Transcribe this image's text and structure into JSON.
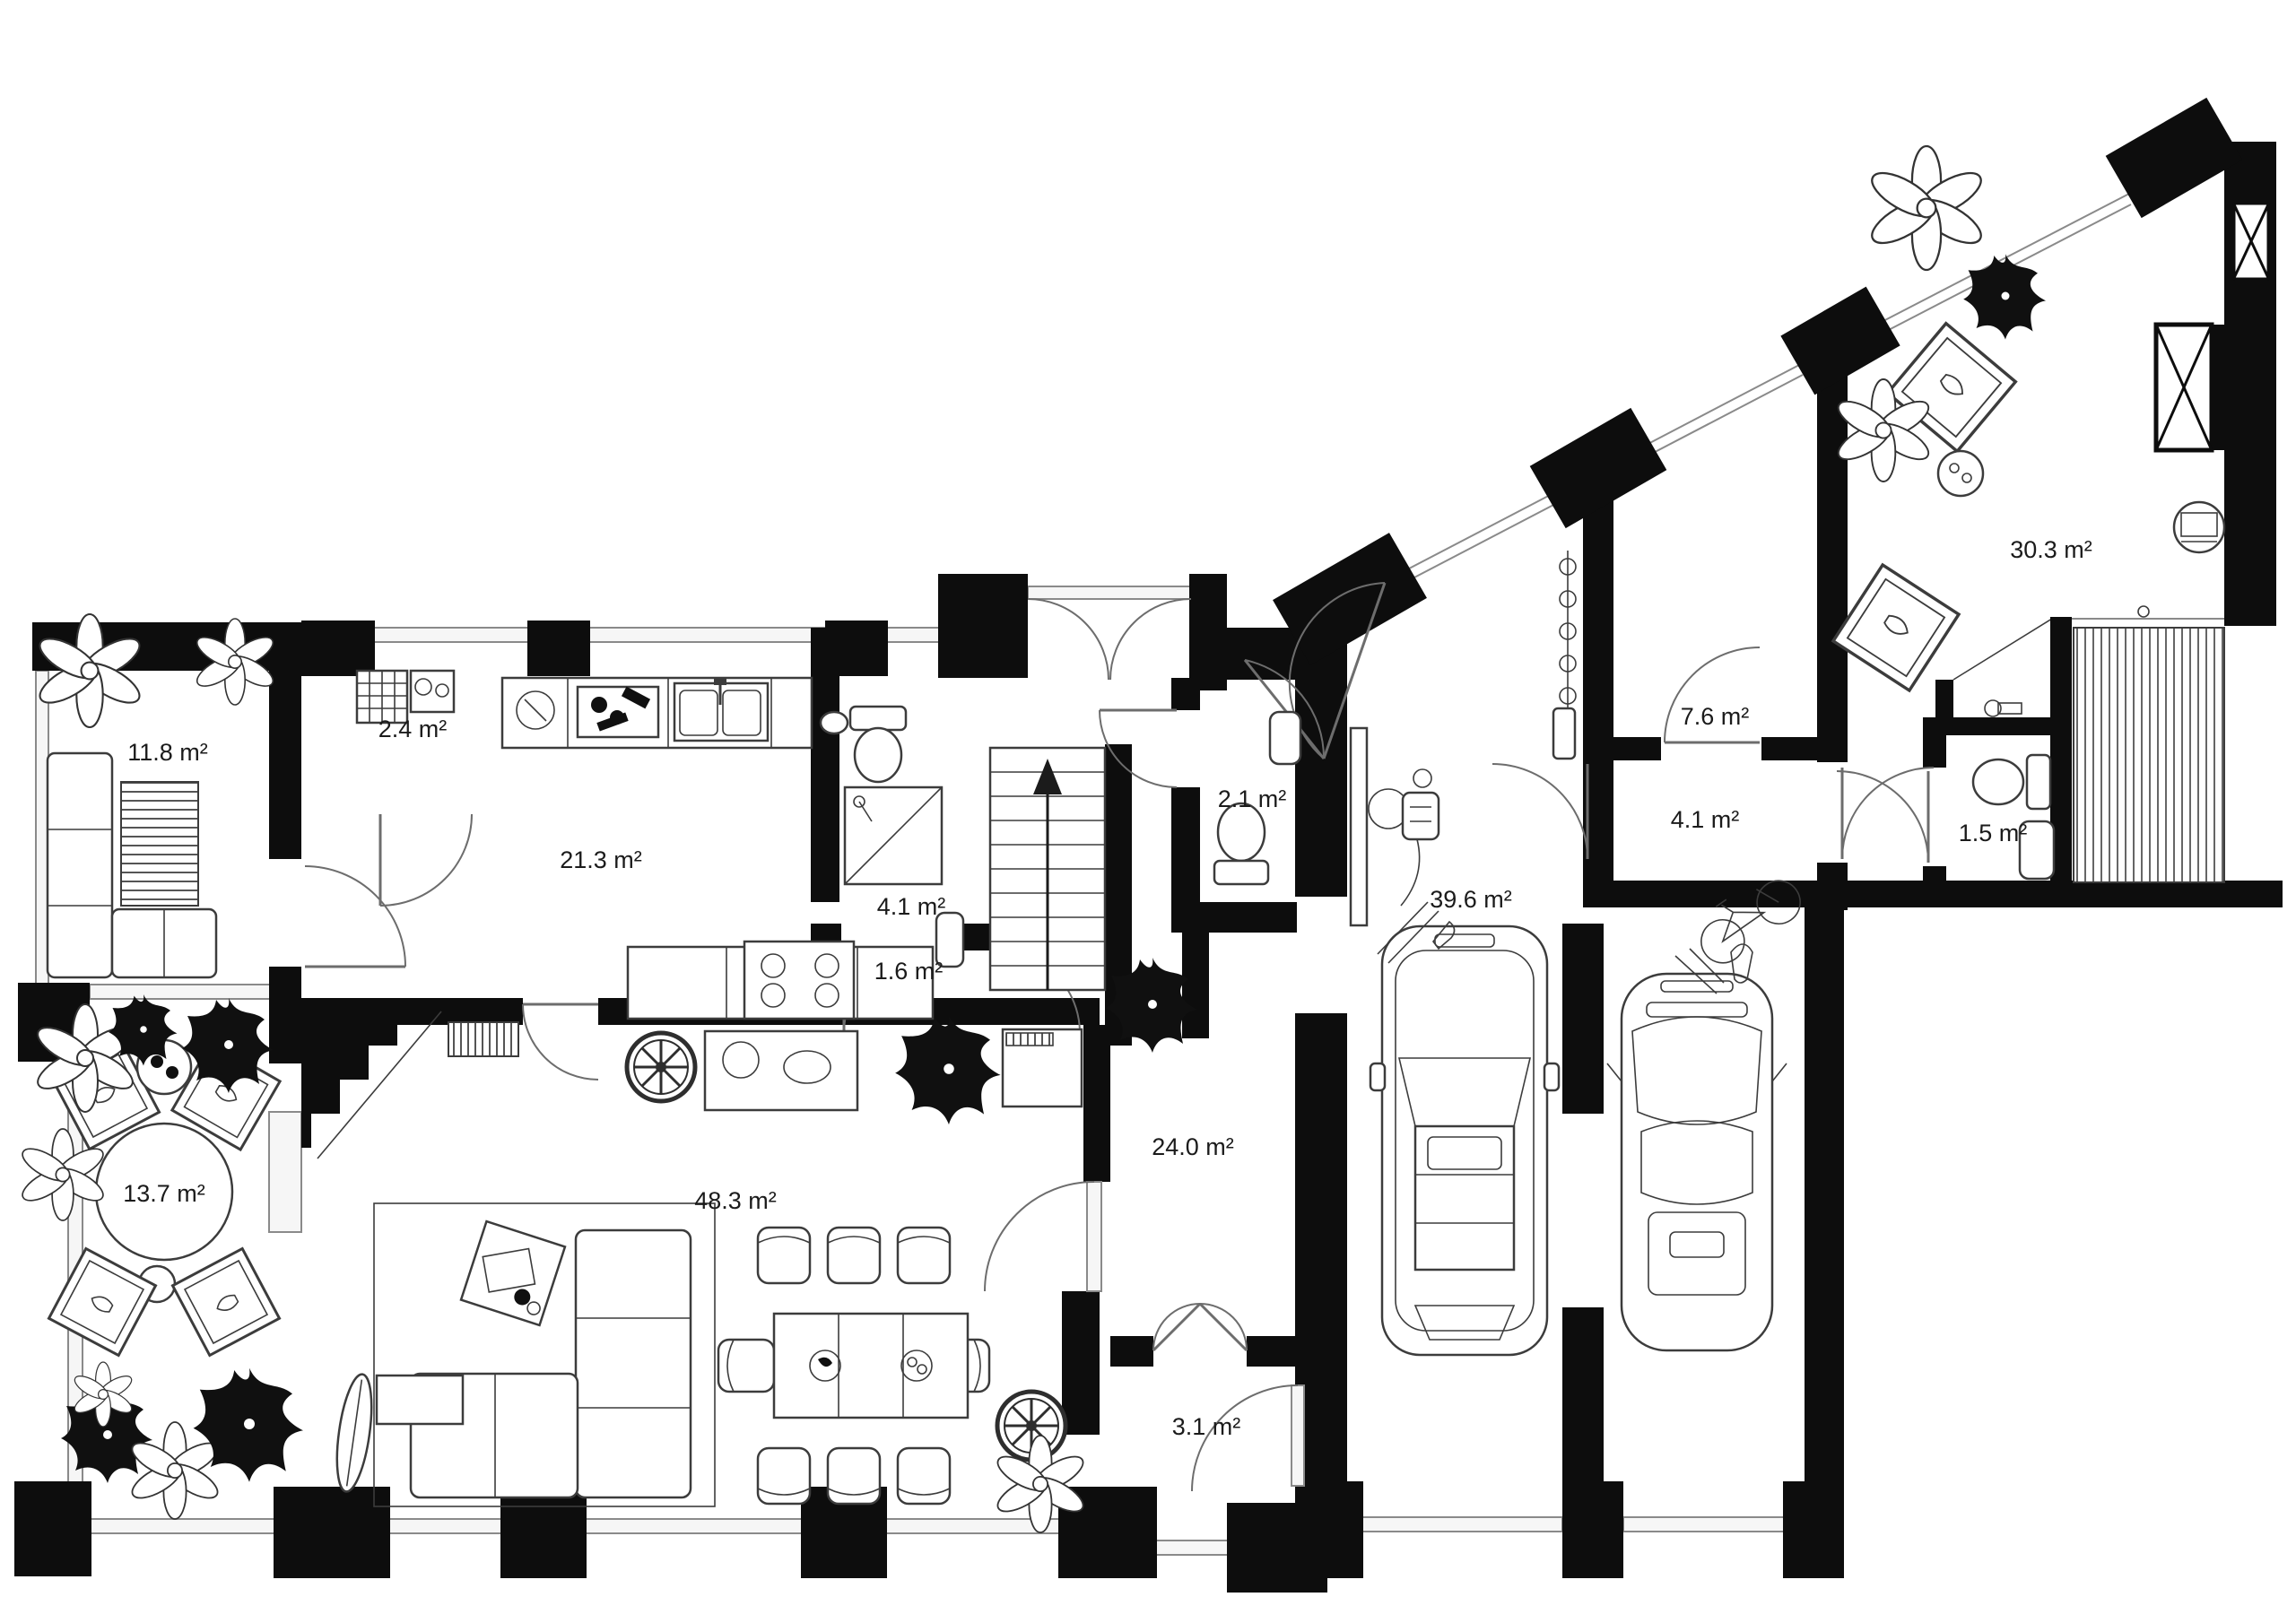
{
  "plan": {
    "type": "architectural-floor-plan",
    "background_color": "#ffffff",
    "wall_color": "#0d0d0d",
    "furniture_line_color": "#3c3c3c",
    "glazing_color": "#8a8a8a",
    "label_color": "#1b1b1b",
    "area_unit": "m²",
    "rooms": [
      {
        "id": "loggia",
        "label": "11.8 m²"
      },
      {
        "id": "pantry",
        "label": "2.4 m²"
      },
      {
        "id": "kitchen",
        "label": "21.3 m²"
      },
      {
        "id": "bathroom",
        "label": "4.1 m²"
      },
      {
        "id": "small-hall",
        "label": "1.6 m²"
      },
      {
        "id": "wc",
        "label": "2.1 m²"
      },
      {
        "id": "hallway",
        "label": "7.6 m²"
      },
      {
        "id": "studio",
        "label": "30.3 m²"
      },
      {
        "id": "entry-hall",
        "label": "4.1 m²"
      },
      {
        "id": "small-wc",
        "label": "1.5 m²"
      },
      {
        "id": "garage",
        "label": "39.6 m²"
      },
      {
        "id": "corridor",
        "label": "24.0 m²"
      },
      {
        "id": "living-room",
        "label": "48.3 m²"
      },
      {
        "id": "terrace",
        "label": "13.7 m²"
      },
      {
        "id": "vestibule",
        "label": "3.1 m²"
      }
    ]
  }
}
